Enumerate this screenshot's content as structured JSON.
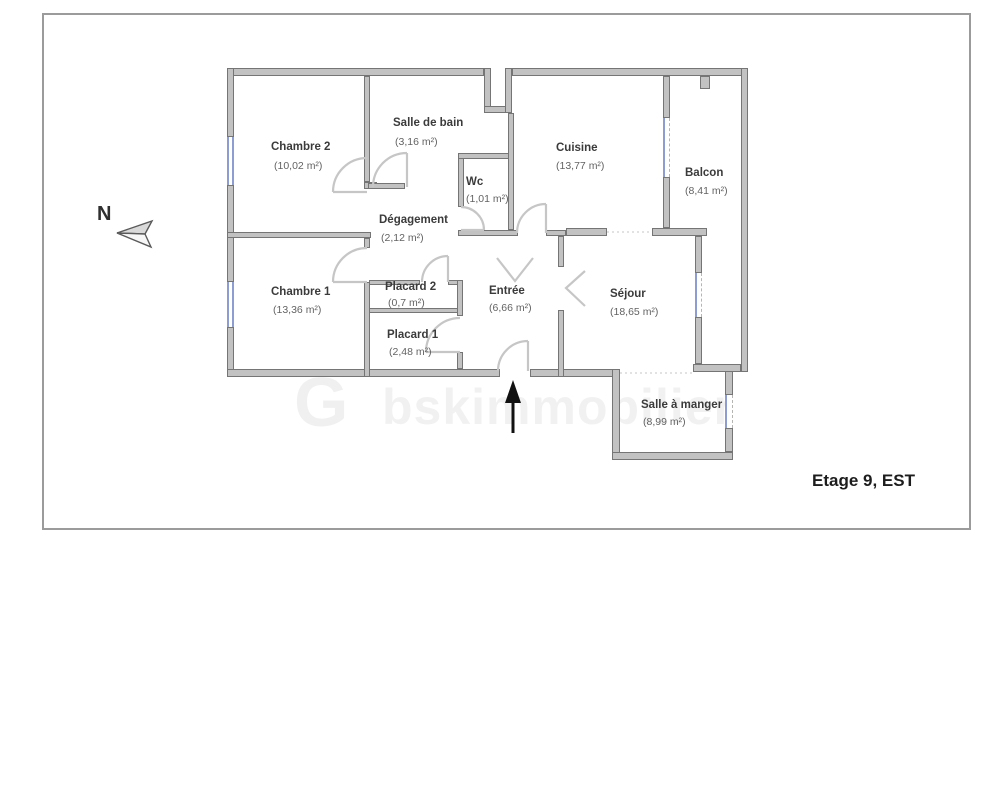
{
  "title": "Etage 9, EST",
  "compass": {
    "label": "N"
  },
  "watermark": {
    "logo_letter": "G",
    "text": "bskimmobilier"
  },
  "rooms": [
    {
      "name": "Chambre 2",
      "area": "(10,02 m²)"
    },
    {
      "name": "Salle de bain",
      "area": "(3,16 m²)"
    },
    {
      "name": "Wc",
      "area": "(1,01 m²)"
    },
    {
      "name": "Cuisine",
      "area": "(13,77 m²)"
    },
    {
      "name": "Balcon",
      "area": "(8,41 m²)"
    },
    {
      "name": "Dégagement",
      "area": "(2,12 m²)"
    },
    {
      "name": "Chambre 1",
      "area": "(13,36 m²)"
    },
    {
      "name": "Placard 2",
      "area": "(0,7 m²)"
    },
    {
      "name": "Placard 1",
      "area": "(2,48 m²)"
    },
    {
      "name": "Entrée",
      "area": "(6,66 m²)"
    },
    {
      "name": "Séjour",
      "area": "(18,65 m²)"
    },
    {
      "name": "Salle à manger",
      "area": "(8,99 m²)"
    }
  ],
  "colors": {
    "wall_fill": "#c2c2c2",
    "wall_edge": "#757575",
    "window_blue": "#8d9cd4",
    "door_arc": "#c6c6c6",
    "entrance_arrow": "#111111"
  }
}
